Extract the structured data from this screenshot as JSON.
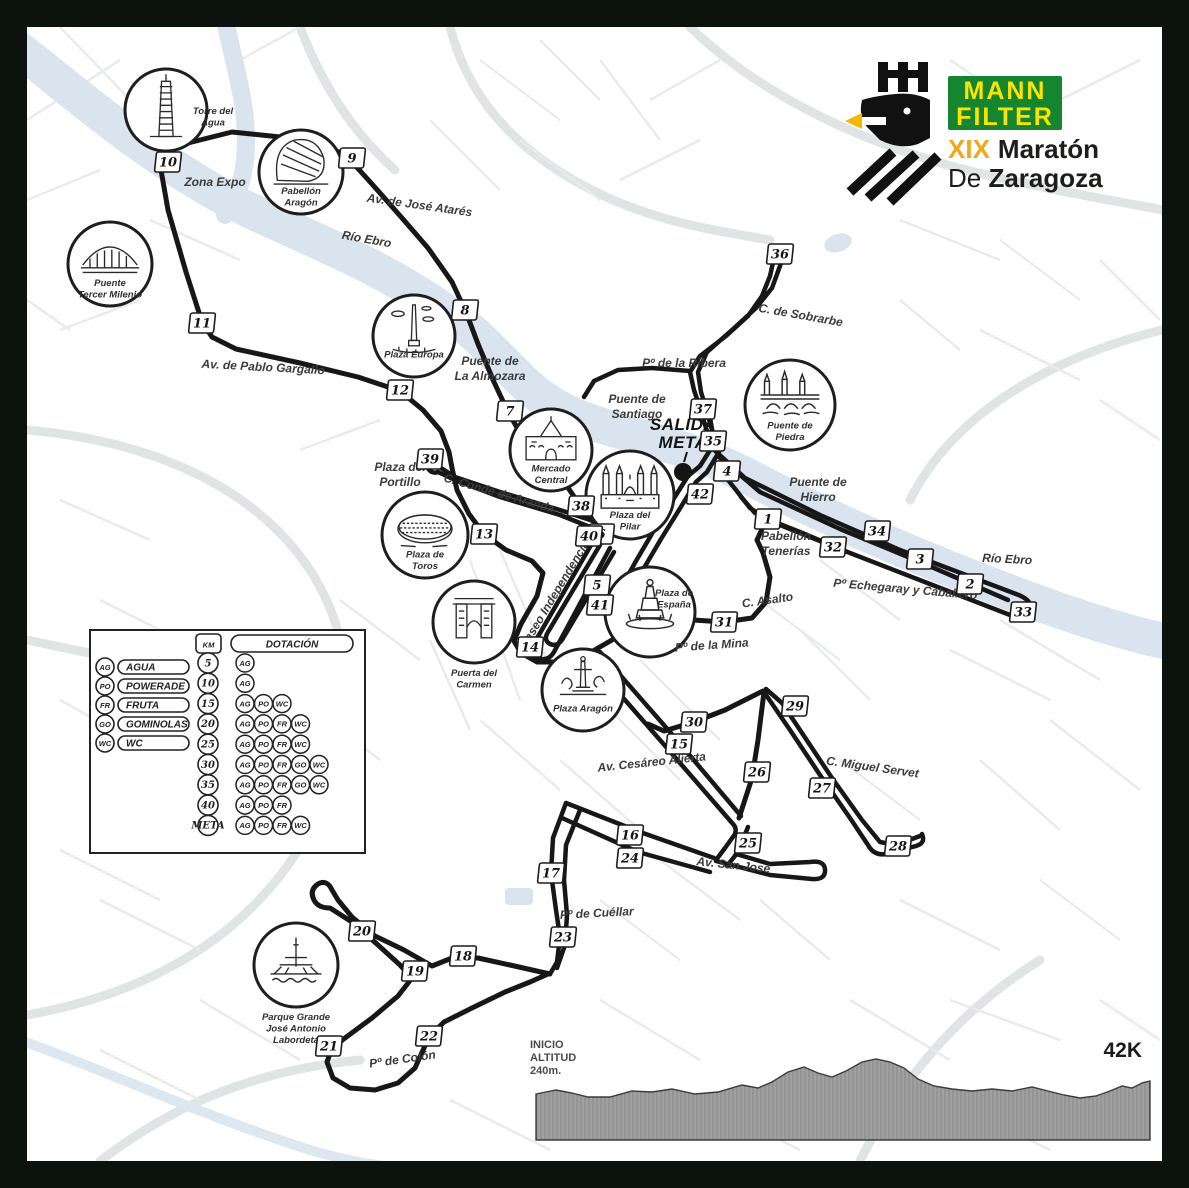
{
  "logo": {
    "brand_line1": "MANN",
    "brand_line2": "FILTER",
    "brand_bg": "#15862f",
    "brand_text_color": "#fbe400",
    "edition": "XIX",
    "edition_color": "#f0a818",
    "title_word": "Maratón",
    "title_line2_regular": "De ",
    "title_line2_bold": "Zaragoza",
    "title_color": "#1d1d1b"
  },
  "start": {
    "label_line1": "SALIDA",
    "label_line2": "META"
  },
  "route_color": "#171717",
  "river_color": "#d9e4ef",
  "route_markers": [
    {
      "n": "1",
      "x": 768,
      "y": 519
    },
    {
      "n": "2",
      "x": 970,
      "y": 584
    },
    {
      "n": "3",
      "x": 920,
      "y": 559
    },
    {
      "n": "4",
      "x": 727,
      "y": 471
    },
    {
      "n": "5",
      "x": 597,
      "y": 585
    },
    {
      "n": "6",
      "x": 601,
      "y": 534
    },
    {
      "n": "7",
      "x": 510,
      "y": 411
    },
    {
      "n": "8",
      "x": 465,
      "y": 310
    },
    {
      "n": "9",
      "x": 352,
      "y": 158
    },
    {
      "n": "10",
      "x": 168,
      "y": 162
    },
    {
      "n": "11",
      "x": 202,
      "y": 323
    },
    {
      "n": "12",
      "x": 400,
      "y": 390
    },
    {
      "n": "13",
      "x": 484,
      "y": 534
    },
    {
      "n": "14",
      "x": 530,
      "y": 647
    },
    {
      "n": "15",
      "x": 679,
      "y": 744
    },
    {
      "n": "16",
      "x": 630,
      "y": 835
    },
    {
      "n": "17",
      "x": 551,
      "y": 873
    },
    {
      "n": "18",
      "x": 463,
      "y": 956
    },
    {
      "n": "19",
      "x": 415,
      "y": 971
    },
    {
      "n": "20",
      "x": 362,
      "y": 931
    },
    {
      "n": "21",
      "x": 329,
      "y": 1046
    },
    {
      "n": "22",
      "x": 429,
      "y": 1036
    },
    {
      "n": "23",
      "x": 563,
      "y": 937
    },
    {
      "n": "24",
      "x": 630,
      "y": 858
    },
    {
      "n": "25",
      "x": 748,
      "y": 843
    },
    {
      "n": "26",
      "x": 757,
      "y": 772
    },
    {
      "n": "27",
      "x": 822,
      "y": 788
    },
    {
      "n": "28",
      "x": 898,
      "y": 846
    },
    {
      "n": "29",
      "x": 795,
      "y": 706
    },
    {
      "n": "30",
      "x": 694,
      "y": 722
    },
    {
      "n": "31",
      "x": 724,
      "y": 622
    },
    {
      "n": "32",
      "x": 833,
      "y": 547
    },
    {
      "n": "33",
      "x": 1023,
      "y": 612
    },
    {
      "n": "34",
      "x": 877,
      "y": 531
    },
    {
      "n": "35",
      "x": 713,
      "y": 441
    },
    {
      "n": "36",
      "x": 780,
      "y": 254
    },
    {
      "n": "37",
      "x": 703,
      "y": 409
    },
    {
      "n": "38",
      "x": 581,
      "y": 506
    },
    {
      "n": "39",
      "x": 430,
      "y": 459
    },
    {
      "n": "40",
      "x": 589,
      "y": 536
    },
    {
      "n": "41",
      "x": 600,
      "y": 605
    },
    {
      "n": "42",
      "x": 700,
      "y": 494
    }
  ],
  "landmarks": [
    {
      "id": "torre-del-agua",
      "x": 166,
      "y": 110,
      "r": 41,
      "sketch": "tower",
      "caption": [
        "Torre del",
        "Agua"
      ],
      "cap_pos": "right"
    },
    {
      "id": "pabellon-aragon",
      "x": 301,
      "y": 172,
      "r": 42,
      "sketch": "pavilion",
      "caption": [
        "Pabellón",
        "Aragón"
      ],
      "cap_pos": "inside"
    },
    {
      "id": "puente-tercer-milenio",
      "x": 110,
      "y": 264,
      "r": 42,
      "sketch": "bridge",
      "caption": [
        "Puente",
        "Tercer Milenio"
      ],
      "cap_pos": "inside"
    },
    {
      "id": "plaza-europa",
      "x": 414,
      "y": 336,
      "r": 41,
      "sketch": "obelisk",
      "caption": [
        "Plaza Europa"
      ],
      "cap_pos": "inside"
    },
    {
      "id": "mercado-central",
      "x": 551,
      "y": 450,
      "r": 41,
      "sketch": "market",
      "caption": [
        "Mercado",
        "Central"
      ],
      "cap_pos": "inside"
    },
    {
      "id": "plaza-del-pilar",
      "x": 630,
      "y": 495,
      "r": 44,
      "sketch": "basilica",
      "caption": [
        "Plaza del",
        "Pilar"
      ],
      "cap_pos": "inside"
    },
    {
      "id": "puente-de-piedra",
      "x": 790,
      "y": 405,
      "r": 45,
      "sketch": "bridge2",
      "caption": [
        "Puente de",
        "Piedra"
      ],
      "cap_pos": "inside"
    },
    {
      "id": "plaza-de-toros",
      "x": 425,
      "y": 535,
      "r": 43,
      "sketch": "bullring",
      "caption": [
        "Plaza de",
        "Toros"
      ],
      "cap_pos": "inside"
    },
    {
      "id": "puerta-del-carmen",
      "x": 474,
      "y": 622,
      "r": 41,
      "sketch": "gate",
      "caption": [
        "Puerta del",
        "Carmen"
      ],
      "cap_pos": "below"
    },
    {
      "id": "plaza-de-espana",
      "x": 650,
      "y": 612,
      "r": 45,
      "sketch": "column",
      "caption": [
        "Plaza de",
        "España"
      ],
      "cap_pos": "right-in"
    },
    {
      "id": "plaza-aragon",
      "x": 583,
      "y": 690,
      "r": 41,
      "sketch": "column2",
      "caption": [
        "Plaza Aragón"
      ],
      "cap_pos": "inside"
    },
    {
      "id": "parque-grande",
      "x": 296,
      "y": 965,
      "r": 42,
      "sketch": "fountain",
      "caption": [
        "Parque Grande",
        "José Antonio",
        "Labordeta"
      ],
      "cap_pos": "below"
    }
  ],
  "street_labels": [
    {
      "text": "Zona Expo",
      "x": 215,
      "y": 186,
      "rot": 0,
      "s": 13
    },
    {
      "text": "Av. de José Atarés",
      "x": 419,
      "y": 209,
      "rot": 8,
      "s": 12
    },
    {
      "text": "Río Ebro",
      "x": 366,
      "y": 243,
      "rot": 10,
      "s": 12
    },
    {
      "text": "Av. de Pablo Gargallo",
      "x": 263,
      "y": 371,
      "rot": 3,
      "s": 12
    },
    {
      "text": "Puente de",
      "x": 490,
      "y": 365,
      "rot": 0,
      "s": 12
    },
    {
      "text": "La Almozara",
      "x": 490,
      "y": 380,
      "rot": 0,
      "s": 12
    },
    {
      "text": "Puente de",
      "x": 637,
      "y": 403,
      "rot": 0,
      "s": 12
    },
    {
      "text": "Santiago",
      "x": 637,
      "y": 418,
      "rot": 0,
      "s": 12
    },
    {
      "text": "Pº de la Ribera",
      "x": 684,
      "y": 367,
      "rot": 0,
      "s": 12
    },
    {
      "text": "C. de Sobrarbe",
      "x": 800,
      "y": 319,
      "rot": 10,
      "s": 12
    },
    {
      "text": "Puente de",
      "x": 818,
      "y": 486,
      "rot": 0,
      "s": 12
    },
    {
      "text": "Hierro",
      "x": 818,
      "y": 501,
      "rot": 0,
      "s": 12
    },
    {
      "text": "Pabellón",
      "x": 786,
      "y": 540,
      "rot": 0,
      "s": 12
    },
    {
      "text": "Tenerías",
      "x": 786,
      "y": 555,
      "rot": 0,
      "s": 12
    },
    {
      "text": "Pº Echegaray y Caballero",
      "x": 905,
      "y": 593,
      "rot": 5,
      "s": 11.5
    },
    {
      "text": "Río Ebro",
      "x": 1007,
      "y": 563,
      "rot": 3,
      "s": 12
    },
    {
      "text": "Plaza del",
      "x": 400,
      "y": 471,
      "rot": 0,
      "s": 12
    },
    {
      "text": "Portillo",
      "x": 400,
      "y": 486,
      "rot": 0,
      "s": 12
    },
    {
      "text": "C. Conde de Aranda",
      "x": 498,
      "y": 497,
      "rot": 16,
      "s": 12.5
    },
    {
      "text": "Paseo Independencia",
      "x": 558,
      "y": 596,
      "rot": -59,
      "s": 12.5
    },
    {
      "text": "C. Asalto",
      "x": 768,
      "y": 604,
      "rot": -8,
      "s": 12
    },
    {
      "text": "Pº de la Mina",
      "x": 712,
      "y": 649,
      "rot": -4,
      "s": 12
    },
    {
      "text": "Av. Cesáreo Alierta",
      "x": 652,
      "y": 766,
      "rot": -6,
      "s": 12
    },
    {
      "text": "C. Miguel Servet",
      "x": 872,
      "y": 771,
      "rot": 8,
      "s": 12
    },
    {
      "text": "Av. San José",
      "x": 733,
      "y": 869,
      "rot": 6,
      "s": 12
    },
    {
      "text": "Pº de Cuéllar",
      "x": 597,
      "y": 917,
      "rot": -3,
      "s": 12
    },
    {
      "text": "Pº de Colón",
      "x": 403,
      "y": 1063,
      "rot": -8,
      "s": 12
    }
  ],
  "legend": {
    "headers": {
      "km": "KM",
      "dotacion": "DOTACIÓN"
    },
    "keys": [
      {
        "code": "AG",
        "label": "AGUA"
      },
      {
        "code": "PO",
        "label": "POWERADE"
      },
      {
        "code": "FR",
        "label": "FRUTA"
      },
      {
        "code": "GO",
        "label": "GOMINOLAS"
      },
      {
        "code": "WC",
        "label": "WC"
      }
    ],
    "rows": [
      {
        "km": "5",
        "services": [
          "AG"
        ]
      },
      {
        "km": "10",
        "services": [
          "AG"
        ]
      },
      {
        "km": "15",
        "services": [
          "AG",
          "PO",
          "WC"
        ]
      },
      {
        "km": "20",
        "services": [
          "AG",
          "PO",
          "FR",
          "WC"
        ]
      },
      {
        "km": "25",
        "services": [
          "AG",
          "PO",
          "FR",
          "WC"
        ]
      },
      {
        "km": "30",
        "services": [
          "AG",
          "PO",
          "FR",
          "GO",
          "WC"
        ]
      },
      {
        "km": "35",
        "services": [
          "AG",
          "PO",
          "FR",
          "GO",
          "WC"
        ]
      },
      {
        "km": "40",
        "services": [
          "AG",
          "PO",
          "FR"
        ]
      },
      {
        "km": "META",
        "services": [
          "AG",
          "PO",
          "FR",
          "WC"
        ]
      }
    ]
  },
  "elevation": {
    "start_label": [
      "INICIO",
      "ALTITUD",
      "240m."
    ],
    "distance_label": "42K"
  }
}
